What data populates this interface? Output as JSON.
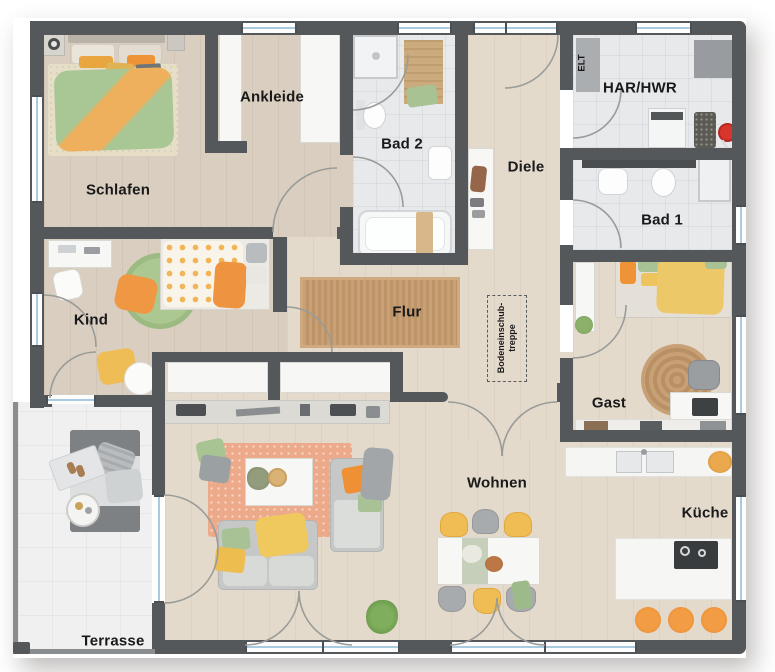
{
  "plan": {
    "rooms": {
      "schlafen": "Schlafen",
      "ankleide": "Ankleide",
      "bad2": "Bad 2",
      "diele": "Diele",
      "elt": "ELT",
      "har_hwr": "HAR/HWR",
      "bad1": "Bad 1",
      "kind": "Kind",
      "flur": "Flur",
      "gast": "Gast",
      "wohnen": "Wohnen",
      "kueche": "Küche",
      "terrasse": "Terrasse"
    },
    "attic_stairs": {
      "line1": "Bodeneinschub-",
      "line2": "treppe"
    },
    "colors": {
      "wall": "#55585b",
      "wood_floor": "#d9cec0",
      "wood_floor_light": "#e4dacc",
      "tile_floor": "#e7e9eb",
      "terrace_floor": "#f0f0f1",
      "window_glass": "#aacbdf",
      "accent_orange": "#ef9236",
      "accent_yellow": "#f0c45e",
      "accent_green": "#a9c295",
      "rug_salmon": "#edaa8b",
      "rug_jute": "#c49a6e"
    }
  }
}
